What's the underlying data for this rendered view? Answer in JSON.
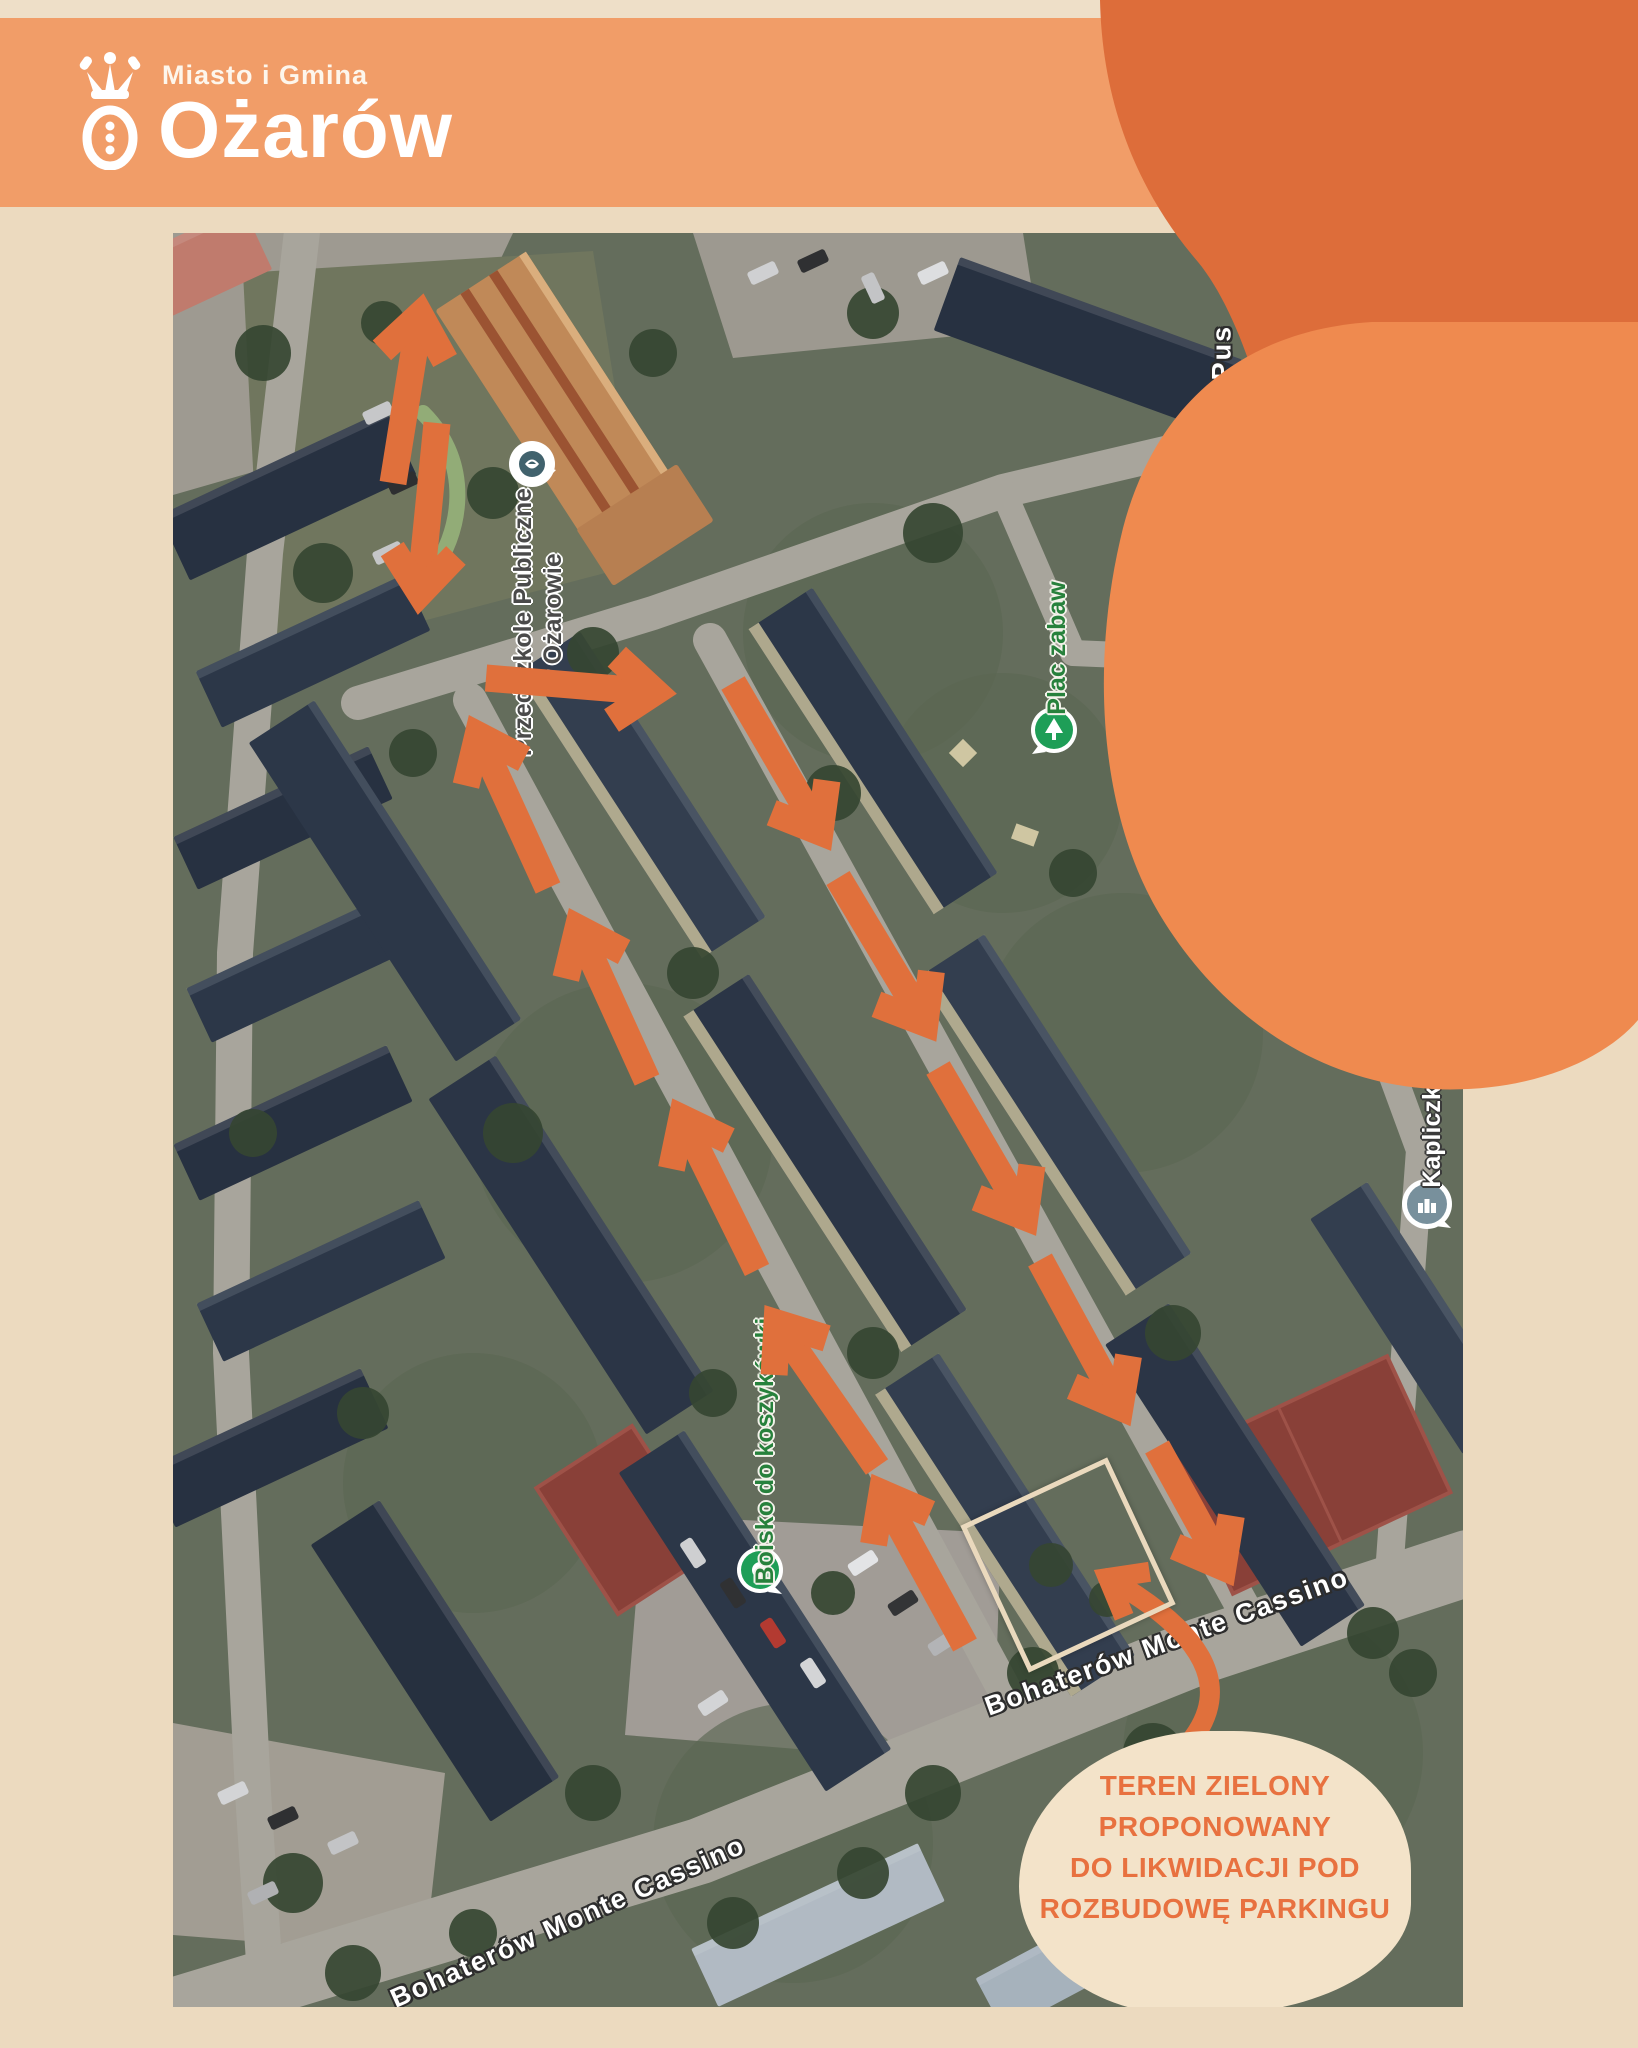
{
  "page": {
    "background": "#ecdabf",
    "top_strip": "#eedfc8"
  },
  "header": {
    "background": "#f19d68",
    "pretitle": "Miasto i Gmina",
    "title": "Ożarów",
    "text_color": "#ffffff",
    "logo": "crown-and-ring-emblem"
  },
  "decor": {
    "dark_blob_color": "#dd6d3a",
    "light_blob_color": "#ef8a4f"
  },
  "map": {
    "frame": {
      "left": 173,
      "top": 233,
      "width": 1290,
      "height": 1774
    },
    "arrows": {
      "color": "#e0703c",
      "stroke_width": 27,
      "head_length": 52,
      "head_angle": 38,
      "items": [
        [
          220,
          250,
          247,
          82
        ],
        [
          264,
          190,
          247,
          360
        ],
        [
          313,
          445,
          482,
          459
        ],
        [
          560,
          450,
          647,
          599
        ],
        [
          665,
          645,
          752,
          790
        ],
        [
          765,
          835,
          852,
          984
        ],
        [
          867,
          1027,
          947,
          1174
        ],
        [
          984,
          1214,
          1050,
          1334
        ],
        [
          792,
          1412,
          709,
          1260
        ],
        [
          704,
          1234,
          604,
          1090
        ],
        [
          584,
          1037,
          509,
          885
        ],
        [
          474,
          847,
          405,
          695
        ],
        [
          375,
          655,
          305,
          502
        ]
      ]
    },
    "curved_arrow": {
      "start": [
        1017,
        1509
      ],
      "control": [
        1082,
        1428
      ],
      "end": [
        935,
        1345
      ],
      "stroke_width": 20,
      "head_length": 42
    },
    "highlight_rect": {
      "cx": 895,
      "cy": 1332,
      "size": 152,
      "rotate": -25,
      "border_color": "#ead9bd"
    },
    "pois": [
      {
        "id": "przedszkole",
        "icon": "school-pin",
        "icon_x": 359,
        "icon_y": 233,
        "label": {
          "lines": [
            "Przedszkole Publiczne",
            "w Ożarowie"
          ],
          "x": 365,
          "y": 389,
          "rotate": -90,
          "style": "dark"
        }
      },
      {
        "id": "plac-zabaw",
        "icon": "playground-pin",
        "icon_x": 881,
        "icon_y": 499,
        "label": {
          "lines": [
            "Plac zabaw"
          ],
          "x": 884,
          "y": 415,
          "rotate": -90,
          "style": "green"
        }
      },
      {
        "id": "dpd-pickup",
        "icon": "parcel-pin",
        "icon_x": 1099,
        "icon_y": 459,
        "label": {
          "lines": [
            "DPD Pickup Station",
            "- automat paczkowy"
          ],
          "x": 1108,
          "y": 585,
          "rotate": -90,
          "style": "white"
        }
      },
      {
        "id": "kapliczka",
        "icon": "chapel-pin",
        "icon_x": 1254,
        "icon_y": 973,
        "label": {
          "lines": [
            "Kapliczka"
          ],
          "x": 1259,
          "y": 897,
          "rotate": -90,
          "style": "white"
        }
      },
      {
        "id": "boisko",
        "icon": "sports-pin",
        "icon_x": 587,
        "icon_y": 1339,
        "label": {
          "lines": [
            "Boisko do koszykówki"
          ],
          "x": 592,
          "y": 1218,
          "rotate": -90,
          "style": "green"
        }
      }
    ],
    "street_labels": [
      {
        "text": "Bohaterów Monte Cassino",
        "x": 994,
        "y": 1409,
        "rotate": -20
      },
      {
        "text": "Bohaterów Monte Cassino",
        "x": 395,
        "y": 1689,
        "rotate": -24
      },
      {
        "text": "\"Pus",
        "x": 1049,
        "y": 127,
        "rotate": -90
      }
    ],
    "callout": {
      "background": "#f3e3c9",
      "text_color": "#e8713f",
      "cx": 1042,
      "cy": 1640,
      "rx": 196,
      "ry": 142,
      "lines": [
        "TEREN ZIELONY",
        "PROPONOWANY",
        "DO LIKWIDACJI POD",
        "ROZBUDOWĘ PARKINGU"
      ]
    }
  }
}
